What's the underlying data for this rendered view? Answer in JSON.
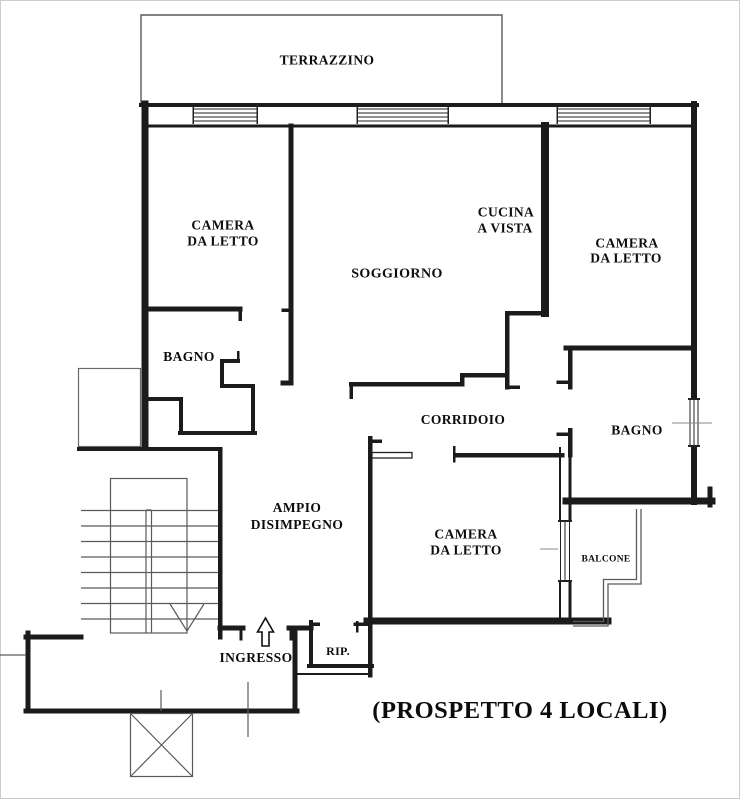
{
  "title": "(PROSPETTO 4 LOCALI)",
  "colors": {
    "wall_ink": "#1b1b1b",
    "thin_line": "#5a5a5a"
  },
  "rooms": {
    "terrazzino": "TERRAZZINO",
    "camera_top_left": {
      "line1": "CAMERA",
      "line2": "DA LETTO"
    },
    "soggiorno": "SOGGIORNO",
    "cucina": {
      "line1": "CUCINA",
      "line2": "A VISTA"
    },
    "camera_top_right": {
      "line1": "CAMERA",
      "line2": "DA LETTO"
    },
    "bagno_left": "BAGNO",
    "corridoio": "CORRIDOIO",
    "bagno_right": "BAGNO",
    "disimpegno": {
      "line1": "AMPIO",
      "line2": "DISIMPEGNO"
    },
    "camera_bottom": {
      "line1": "CAMERA",
      "line2": "DA LETTO"
    },
    "balcone": "BALCONE",
    "ingresso": "INGRESSO",
    "ripostiglio": "RIP."
  }
}
